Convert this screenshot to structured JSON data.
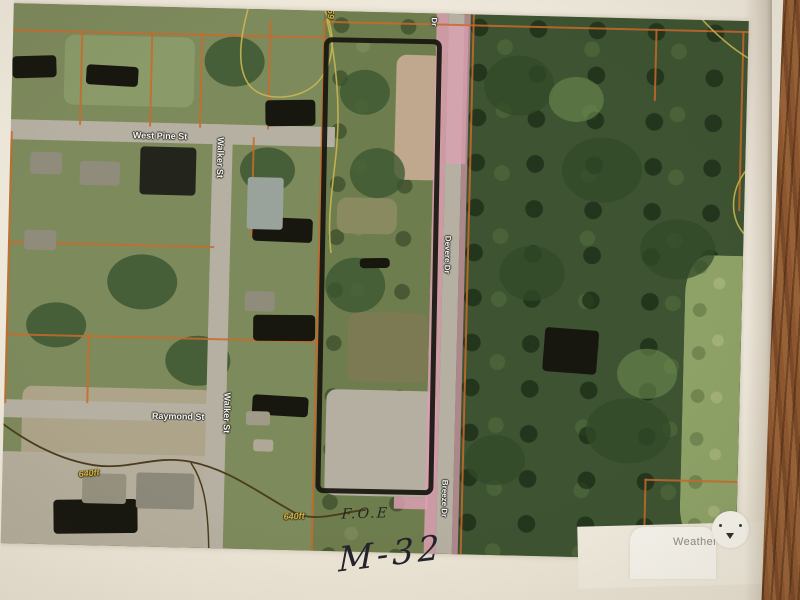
{
  "photo": {
    "margin_note": "M-32"
  },
  "map": {
    "streets": {
      "west_pine": "West Pine St",
      "walker_a": "Walker St",
      "walker_b": "Walker St",
      "raymond": "Raymond St",
      "devere": "Devere Dr",
      "devere_partial": "Dr",
      "breeze": "Breeze Dr"
    },
    "contours": {
      "c640_a": "640ft",
      "c640_b": "640ft",
      "partial_59": "59"
    },
    "notes": {
      "parcel_note": "F.O.E"
    },
    "widget": {
      "weather": "Weather"
    },
    "colors": {
      "parcel_line": "#c96a2a",
      "road_highlight": "#dc9fb2",
      "subject_outline": "#17150f",
      "contour_gold": "#cdb14a",
      "paper": "#f1ecdf",
      "wood": "#8a5531"
    }
  }
}
